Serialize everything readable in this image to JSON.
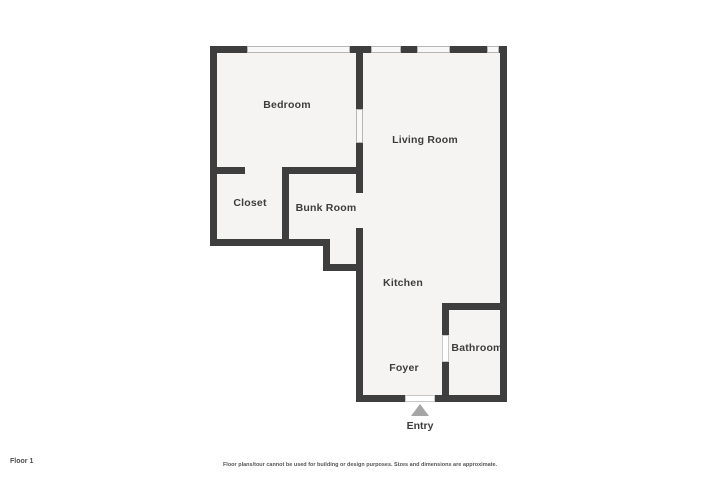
{
  "floorplan": {
    "rooms": {
      "bedroom": {
        "label": "Bedroom"
      },
      "living_room": {
        "label": "Living Room"
      },
      "closet": {
        "label": "Closet"
      },
      "bunk_room": {
        "label": "Bunk Room"
      },
      "kitchen": {
        "label": "Kitchen"
      },
      "bathroom": {
        "label": "Bathroom"
      },
      "foyer": {
        "label": "Foyer"
      }
    },
    "entry": {
      "label": "Entry",
      "arrow_icon": "entry-direction-arrow"
    },
    "colors": {
      "wall": "#3e3e3e",
      "floor_fill": "#f5f4f3",
      "window_fill": "#f8f8f8",
      "window_border": "#b5b5b5",
      "entry_arrow": "#a5a5a5",
      "label_text": "#3d3d3d"
    }
  },
  "footer": {
    "floor_label": "Floor 1",
    "disclaimer": "Floor plans/tour cannot be used for building or design purposes. Sizes and dimensions are approximate."
  }
}
